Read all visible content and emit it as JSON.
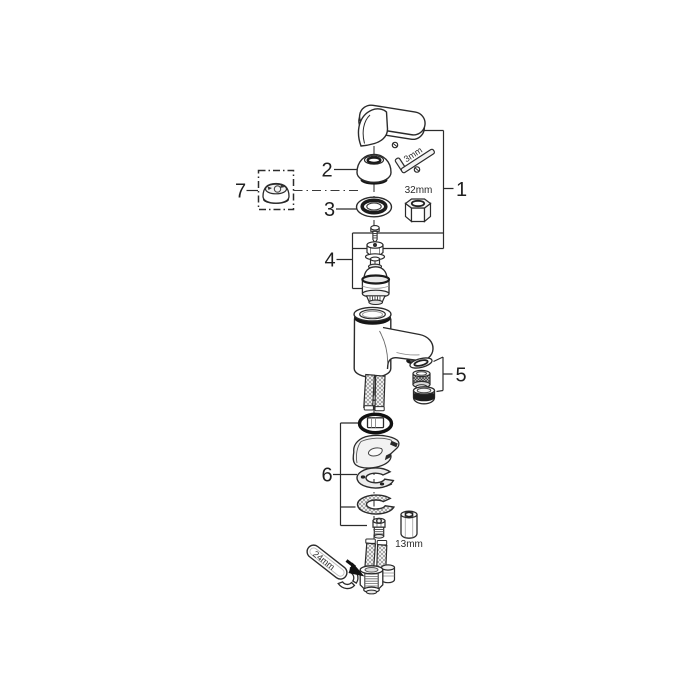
{
  "diagram": {
    "kind": "exploded-parts-diagram",
    "callouts": [
      "1",
      "2",
      "3",
      "4",
      "5",
      "6",
      "7"
    ],
    "tools": {
      "allen_key": "3mm",
      "socket": "32mm",
      "hex_sleeve": "13mm",
      "wrench": "24mm"
    },
    "colors": {
      "background": "#ffffff",
      "line": "#2b2b2b",
      "dark_fill": "#161616",
      "light_fill": "#f2f2f2"
    }
  }
}
